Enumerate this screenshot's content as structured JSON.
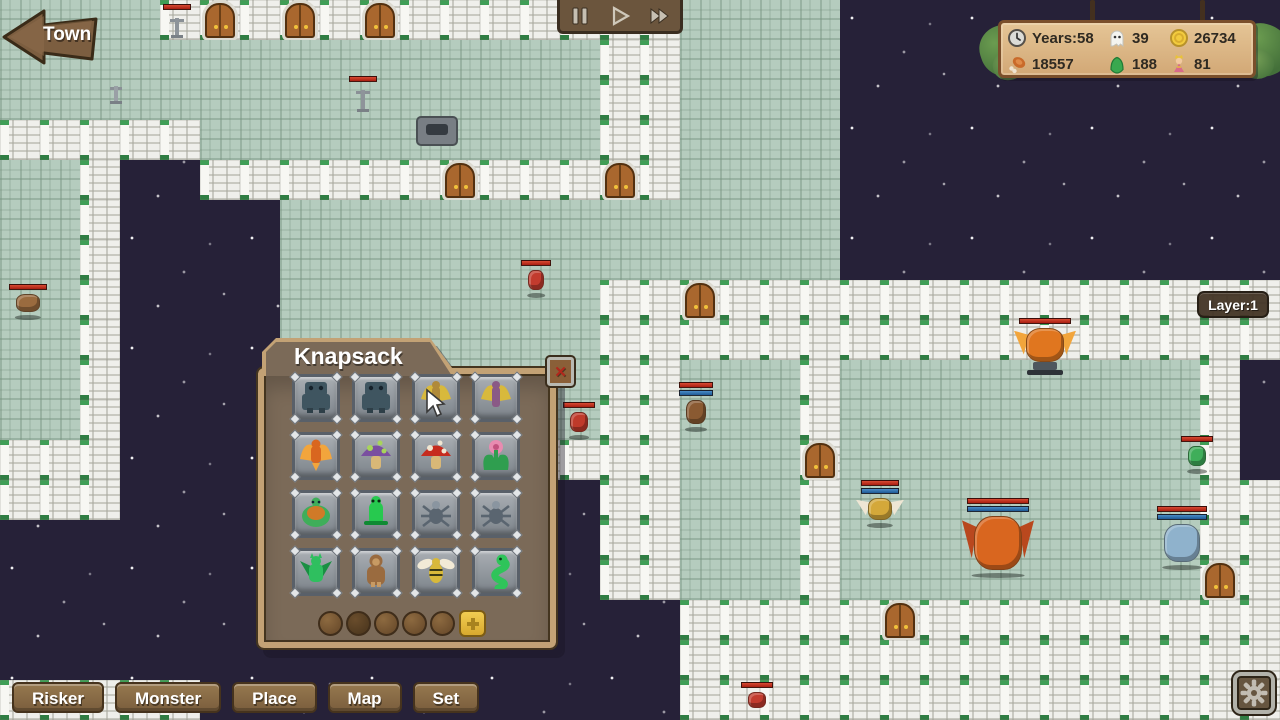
{
  "palette": {
    "floor": "#b5ccbe",
    "floor_line": "#7a9482",
    "wall": "#e9e9e4",
    "pillar_green": "#3f9e56",
    "void": "#262138",
    "door": "#a9672e",
    "hp_red": "#b3271c",
    "hp_blue": "#2e6fae",
    "wood_dark": "#6b553d",
    "wood_light": "#c3a275",
    "sign_board": "#ddbd90",
    "leaf_green": "#5a8a46"
  },
  "map": {
    "tile_size": 40,
    "legend": {
      "f": "floor",
      "w": "wall",
      "d": "door",
      "-": "void"
    },
    "tiles": [
      "ffffwdwdwdwwwwwwwffff-----------",
      "fffffffffffffffwwffff-----------",
      "fffffffffffffffwwffff-----------",
      "wwwwwffffffffffwwffff-----------",
      "ffw--wwwwwwdwwwdwffff-----------",
      "ffw----ffffffffffffff-----------",
      "ffw----ffffffffffffff-----------",
      "ffw----ffffffffwwdwwwwwwwwwwwwww",
      "ffw----ffffffffwwwwwwwwwwwwwwwww",
      "ffw----ffffffffwwfffwfffffffffw-",
      "ffw----ffffffffwwfffwfffffffffw-",
      "www----wwwwwwwwwwfffdfffffffffw-",
      "www------------wwfffwfffffffffww",
      "---------------wwfffwfffffffffww",
      "---------------wwfffwfffffffffdw",
      "-----------------wwwwwdwwwwwwwww",
      "-----------------wwwwwwwwwwwwwww",
      "wwwww------------wwwwwwwwwwwwwww"
    ]
  },
  "entities": [
    {
      "name": "candelabrum",
      "kind": "candelabrum",
      "x": 170,
      "y": 14,
      "w": 14,
      "h": 24,
      "color": "#8e949a",
      "bars": [
        "red"
      ]
    },
    {
      "name": "candelabrum",
      "kind": "candelabrum",
      "x": 110,
      "y": 82,
      "w": 12,
      "h": 22,
      "color": "#9aa0a6",
      "bars": []
    },
    {
      "name": "candelabrum",
      "kind": "candelabrum",
      "x": 356,
      "y": 86,
      "w": 14,
      "h": 26,
      "color": "#8e949a",
      "bars": [
        "red"
      ]
    },
    {
      "name": "altar",
      "kind": "altar",
      "x": 416,
      "y": 116,
      "w": 42,
      "h": 30,
      "color": "#787e84",
      "bars": []
    },
    {
      "name": "imp",
      "kind": "monster",
      "x": 528,
      "y": 270,
      "w": 16,
      "h": 20,
      "color": "#c23b2e",
      "bars": [
        "red"
      ],
      "shadow": true
    },
    {
      "name": "deer",
      "kind": "monster",
      "x": 16,
      "y": 294,
      "w": 24,
      "h": 18,
      "color": "#9a6b3f",
      "bars": [
        "red"
      ],
      "shadow": true
    },
    {
      "name": "bat",
      "kind": "monster",
      "x": 686,
      "y": 400,
      "w": 20,
      "h": 24,
      "color": "#8a5a32",
      "bars": [
        "red",
        "blue"
      ],
      "shadow": true
    },
    {
      "name": "phoenix",
      "kind": "monster",
      "x": 1026,
      "y": 328,
      "w": 38,
      "h": 34,
      "color": "#e0761f",
      "wings": "#f2a53c",
      "bars": [
        "red"
      ],
      "pedestal": true
    },
    {
      "name": "red-bird",
      "kind": "monster",
      "x": 570,
      "y": 412,
      "w": 18,
      "h": 20,
      "color": "#bf3a2a",
      "bars": [
        "red"
      ],
      "shadow": true
    },
    {
      "name": "wasp",
      "kind": "monster",
      "x": 868,
      "y": 498,
      "w": 24,
      "h": 22,
      "color": "#d4a83a",
      "wings": "#eee6d4",
      "bars": [
        "red",
        "blue"
      ],
      "shadow": true
    },
    {
      "name": "dragon",
      "kind": "monster",
      "x": 974,
      "y": 516,
      "w": 48,
      "h": 54,
      "color": "#d9661f",
      "wings": "#b9481e",
      "bars": [
        "red",
        "blue"
      ],
      "shadow": true
    },
    {
      "name": "ice-golem",
      "kind": "monster",
      "x": 1164,
      "y": 524,
      "w": 36,
      "h": 38,
      "color": "#8fb2cc",
      "bars": [
        "red",
        "blue"
      ],
      "shadow": true
    },
    {
      "name": "slime",
      "kind": "monster",
      "x": 1188,
      "y": 446,
      "w": 18,
      "h": 20,
      "color": "#3fae5a",
      "bars": [
        "red"
      ],
      "shadow": true
    },
    {
      "name": "imp",
      "kind": "monster",
      "x": 748,
      "y": 692,
      "w": 18,
      "h": 16,
      "color": "#c23b2e",
      "bars": [
        "red"
      ]
    }
  ],
  "ui": {
    "town_button": {
      "label": "Town"
    },
    "time_controls": {
      "buttons": [
        {
          "name": "pause"
        },
        {
          "name": "play"
        },
        {
          "name": "fast-forward"
        }
      ]
    },
    "layer_badge": {
      "label": "Layer:1"
    },
    "stats_sign": {
      "rows": [
        [
          {
            "icon": "clock",
            "value": "Years:58"
          },
          {
            "icon": "ghost",
            "value": "39"
          },
          {
            "icon": "coin",
            "value": "26734"
          }
        ],
        [
          {
            "icon": "meat",
            "value": "18557"
          },
          {
            "icon": "slime",
            "value": "188"
          },
          {
            "icon": "princess",
            "value": "81"
          }
        ]
      ]
    },
    "knapsack": {
      "title": "Knapsack",
      "close_label": "✕",
      "slots": [
        {
          "name": "stone-golem",
          "kind": "golem",
          "color": "#3f5560",
          "accent": "#2e3f48"
        },
        {
          "name": "stone-golem",
          "kind": "golem",
          "color": "#3f5560",
          "accent": "#2e3f48"
        },
        {
          "name": "winged-idol",
          "kind": "harpy",
          "color": "#b08a3a",
          "accent": "#d8b93c"
        },
        {
          "name": "harpy",
          "kind": "harpy",
          "color": "#8a5a86",
          "accent": "#d8b93c"
        },
        {
          "name": "phoenix",
          "kind": "phoenix",
          "color": "#d9661f",
          "accent": "#f2a53c"
        },
        {
          "name": "purple-mushroom",
          "kind": "mushroom",
          "color": "#7a4fa0",
          "accent": "#a8d45a"
        },
        {
          "name": "red-mushroom",
          "kind": "mushroom",
          "color": "#c62b1e",
          "accent": "#f0e6d2"
        },
        {
          "name": "carnivorous-plant",
          "kind": "plant",
          "color": "#2f9e4f",
          "accent": "#e88bb0"
        },
        {
          "name": "turtle",
          "kind": "turtle",
          "color": "#3fae5a",
          "accent": "#d07a28"
        },
        {
          "name": "lizard",
          "kind": "lizard",
          "color": "#27c94f",
          "accent": "#0f8a33"
        },
        {
          "name": "spider",
          "kind": "spider",
          "color": "#5a6570",
          "accent": "#8a95a0"
        },
        {
          "name": "spider",
          "kind": "spider",
          "color": "#5a6570",
          "accent": "#8a95a0"
        },
        {
          "name": "gargoyle",
          "kind": "gargoyle",
          "color": "#2fbf5f",
          "accent": "#1a8f43"
        },
        {
          "name": "ape",
          "kind": "ape",
          "color": "#9a6b3f",
          "accent": "#c79a63"
        },
        {
          "name": "bee",
          "kind": "bee",
          "color": "#d8b93a",
          "accent": "#f2ead6"
        },
        {
          "name": "snake",
          "kind": "snake",
          "color": "#2fc45a",
          "accent": "#1f9a43"
        }
      ],
      "cursor_slot_index": 2,
      "page_dots": {
        "count": 5,
        "active_index": 1
      },
      "add_button": {
        "icon": "plus"
      }
    },
    "bottom_tabs": [
      "Risker",
      "Monster",
      "Place",
      "Map",
      "Set"
    ],
    "settings_button": {
      "icon": "gear"
    }
  }
}
